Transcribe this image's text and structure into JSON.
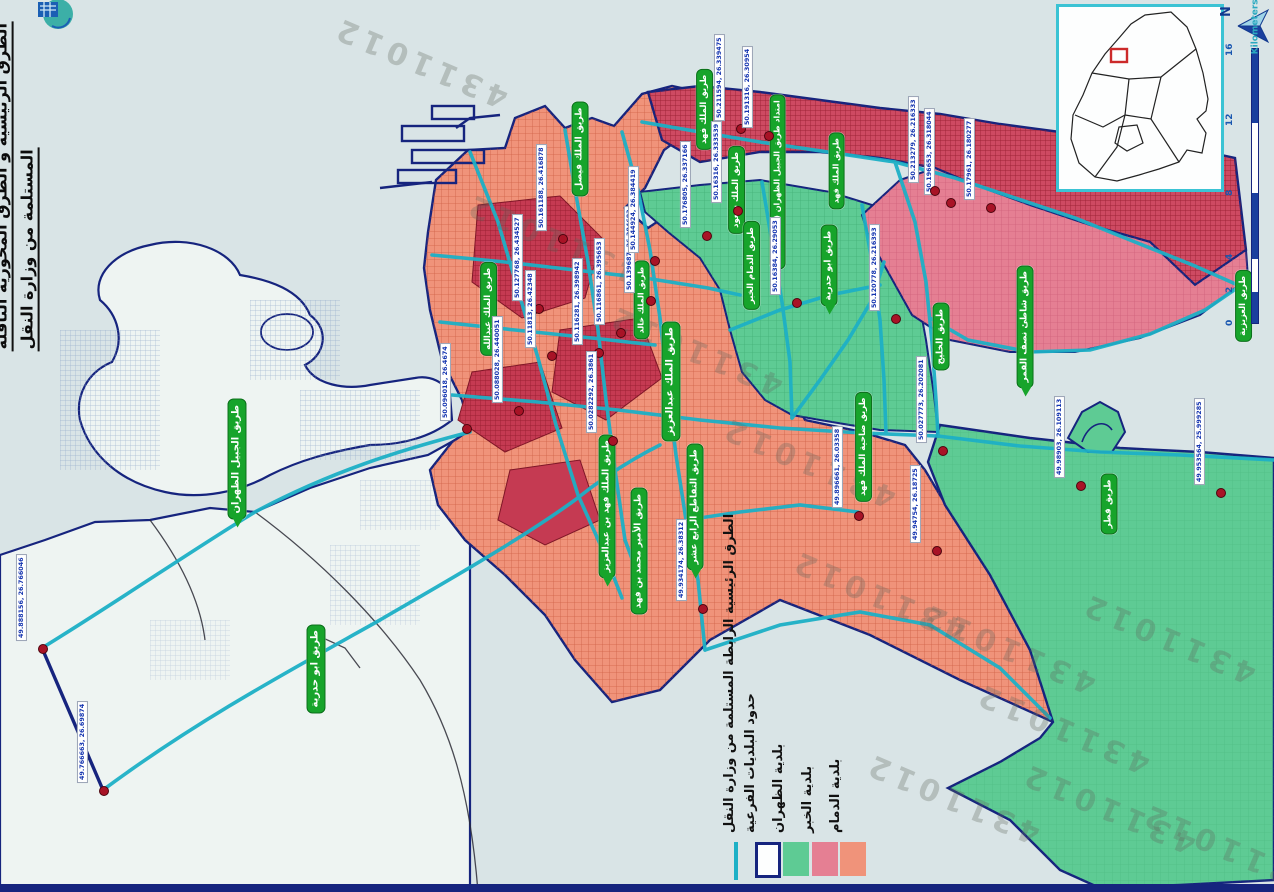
{
  "page": {
    "title_line1": "الطرق الرئيسية و الطرق المحورية الناقلة",
    "title_line2": "المستلمة من وزارة النقل",
    "watermark": "4311012"
  },
  "legend": {
    "items": [
      {
        "label": "الطرق الرئيسية الرابطة المستلمة من وزارة النقل",
        "swatch": "cyan-line",
        "color": "#1db0c6"
      },
      {
        "label": "حدود البلديات الفرعية",
        "swatch": "outlined-box",
        "color": "#16247e"
      },
      {
        "label": "بلدية الظهران",
        "swatch": "fill",
        "color": "#5ecb94"
      },
      {
        "label": "بلدية الخبر",
        "swatch": "fill",
        "color": "#e57f93"
      },
      {
        "label": "بلدية الدمام",
        "swatch": "fill",
        "color": "#f0937a"
      }
    ]
  },
  "scale": {
    "unit": "Kilometers",
    "ticks": [
      {
        "v": "16",
        "x": 1246,
        "y": 60
      },
      {
        "v": "12",
        "x": 1246,
        "y": 130
      },
      {
        "v": "8",
        "x": 1246,
        "y": 200
      },
      {
        "v": "4",
        "x": 1246,
        "y": 264
      },
      {
        "v": "2",
        "x": 1246,
        "y": 297
      },
      {
        "v": "0",
        "x": 1246,
        "y": 330
      }
    ]
  },
  "north": {
    "label": "N"
  },
  "road_labels": [
    {
      "t": "طريق الجبيل الظهران",
      "x": 246,
      "y": 518,
      "fs": 10,
      "cls": "tail"
    },
    {
      "t": "طريق ابو حدرية",
      "x": 325,
      "y": 712,
      "fs": 10
    },
    {
      "t": "طريق ابو حدرية",
      "x": 838,
      "y": 306,
      "fs": 9,
      "cls": "tail"
    },
    {
      "t": "طريق الملك فيصل",
      "x": 589,
      "y": 196,
      "fs": 9
    },
    {
      "t": "امتداد طريق الجبيل الظهران (الملك خالد)",
      "x": 786,
      "y": 270,
      "fs": 8
    },
    {
      "t": "طريق الملك سعود",
      "x": 745,
      "y": 234,
      "fs": 8.5
    },
    {
      "t": "طريق الملك فهد",
      "x": 713,
      "y": 150,
      "fs": 8.5
    },
    {
      "t": "طريق الدمام الخبر",
      "x": 760,
      "y": 310,
      "fs": 8.5
    },
    {
      "t": "طريق الملك عبدالعزيز",
      "x": 680,
      "y": 440,
      "fs": 10
    },
    {
      "t": "طريق الملك فهد بن عبدالعزيز",
      "x": 616,
      "y": 578,
      "fs": 9,
      "cls": "tail"
    },
    {
      "t": "طريق التقاطع الرابع عشر",
      "x": 704,
      "y": 570,
      "fs": 9,
      "cls": "tail"
    },
    {
      "t": "طريق الملك خالد",
      "x": 650,
      "y": 340,
      "fs": 8
    },
    {
      "t": "طريق الأمير محمد بن فهد",
      "x": 648,
      "y": 614,
      "fs": 9
    },
    {
      "t": "طريق الخليج",
      "x": 950,
      "y": 370,
      "fs": 9
    },
    {
      "t": "طريق شاطئ نصف القمر",
      "x": 1034,
      "y": 388,
      "fs": 9,
      "cls": "tail"
    },
    {
      "t": "طريق ضاحية الملك فهد",
      "x": 872,
      "y": 502,
      "fs": 8.5
    },
    {
      "t": "طريق قطر",
      "x": 1118,
      "y": 534,
      "fs": 9
    },
    {
      "t": "طريق العزيزية",
      "x": 1252,
      "y": 342,
      "fs": 8.5
    },
    {
      "t": "طريق الملك عبدالله",
      "x": 497,
      "y": 356,
      "fs": 8.5
    },
    {
      "t": "طريق الملك فهد",
      "x": 845,
      "y": 210,
      "fs": 8
    }
  ],
  "coord_labels": [
    {
      "t": "50.211594, 26.339475",
      "x": 740,
      "y": 128
    },
    {
      "t": "50.191316, 26.30954",
      "x": 768,
      "y": 135
    },
    {
      "t": "50.16316, 26.333539",
      "x": 737,
      "y": 210
    },
    {
      "t": "50.176805, 26.337166",
      "x": 706,
      "y": 235
    },
    {
      "t": "50.161188, 26.416878",
      "x": 562,
      "y": 238
    },
    {
      "t": "50.127768, 26.434527",
      "x": 538,
      "y": 308
    },
    {
      "t": "50.11813, 26.42348",
      "x": 551,
      "y": 355
    },
    {
      "t": "50.116281, 26.398942",
      "x": 598,
      "y": 352
    },
    {
      "t": "50.116861, 26.395653",
      "x": 620,
      "y": 332
    },
    {
      "t": "50.139687, 26.384683",
      "x": 650,
      "y": 300
    },
    {
      "t": "50.144924, 26.384419",
      "x": 654,
      "y": 260
    },
    {
      "t": "50.096018, 26.4674",
      "x": 466,
      "y": 428
    },
    {
      "t": "50.088028, 26.440051",
      "x": 518,
      "y": 410
    },
    {
      "t": "50.0282292, 26.3861",
      "x": 612,
      "y": 440
    },
    {
      "t": "50.16384, 26.29053",
      "x": 796,
      "y": 302
    },
    {
      "t": "50.120778, 26.216393",
      "x": 895,
      "y": 318
    },
    {
      "t": "50.196653, 26.318044",
      "x": 950,
      "y": 202
    },
    {
      "t": "50.17961, 26.180277",
      "x": 990,
      "y": 207
    },
    {
      "t": "50.213279, 26.216333",
      "x": 934,
      "y": 190
    },
    {
      "t": "50.027773, 26.202081",
      "x": 942,
      "y": 450
    },
    {
      "t": "49.98903, 26.109113",
      "x": 1080,
      "y": 485
    },
    {
      "t": "49.953564, 25.999285",
      "x": 1220,
      "y": 492
    },
    {
      "t": "49.896661, 26.03358",
      "x": 858,
      "y": 515
    },
    {
      "t": "49.934174, 26.38312",
      "x": 702,
      "y": 608
    },
    {
      "t": "49.94754, 26.18725",
      "x": 936,
      "y": 550
    },
    {
      "t": "49.888156, 26.766046",
      "x": 42,
      "y": 648
    },
    {
      "t": "49.766663, 26.69874",
      "x": 103,
      "y": 790
    }
  ],
  "watermarks": [
    {
      "x": 420,
      "y": 62
    },
    {
      "x": 552,
      "y": 238
    },
    {
      "x": 695,
      "y": 350
    },
    {
      "x": 808,
      "y": 462
    },
    {
      "x": 878,
      "y": 595
    },
    {
      "x": 1008,
      "y": 648
    },
    {
      "x": 1168,
      "y": 638
    },
    {
      "x": 952,
      "y": 798
    },
    {
      "x": 1108,
      "y": 808
    },
    {
      "x": 1228,
      "y": 848
    },
    {
      "x": 1062,
      "y": 728
    }
  ],
  "colors": {
    "sea": "#d9e4e6",
    "land": "#eef4f2",
    "dammam": "#f0937a",
    "khobar": "#e57f93",
    "khobar_dense": "#ce4a62",
    "dhahran": "#5ecb94",
    "road_main": "#1db0c6",
    "boundary": "#16247e",
    "label_green": "#17a42b",
    "coord_text": "#1535b0",
    "inset_border": "#3bc3d4",
    "marker_red": "#cc2a2a"
  }
}
